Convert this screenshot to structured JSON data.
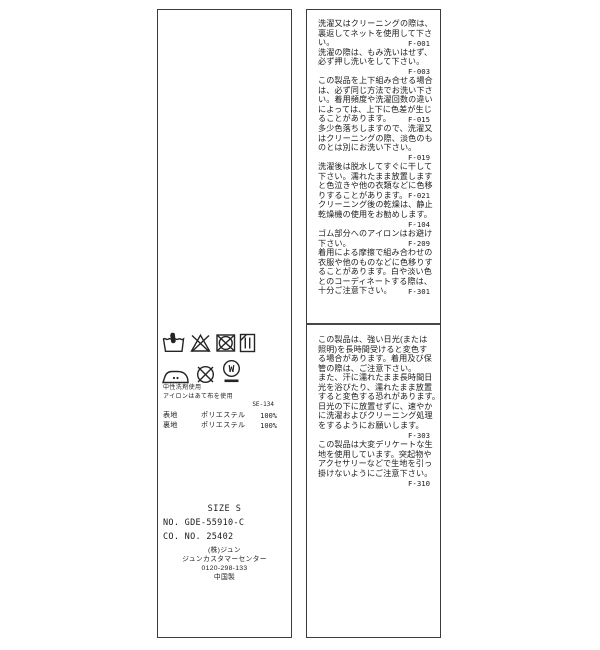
{
  "colors": {
    "background": "#ffffff",
    "label_background": "#ffffff",
    "border": "#3c3c3c",
    "text": "#1c1c1c",
    "divider": "#474747"
  },
  "left_label": {
    "care_symbols_row1": [
      "hand-wash",
      "do-not-bleach",
      "do-not-tumble-dry",
      "drip-dry-in-shade"
    ],
    "care_symbols_row2": [
      "iron-low-heat",
      "do-not-dryclean",
      "wet-clean-professional"
    ],
    "notes": [
      "中性洗剤使用",
      "アイロンはあて布を使用"
    ],
    "care_code": "SE-134",
    "composition": [
      {
        "part": "表地",
        "material": "ポリエステル",
        "pct": "100%"
      },
      {
        "part": "裏地",
        "material": "ポリエステル",
        "pct": "100%"
      }
    ],
    "size": "SIZE S",
    "item_no": "NO. GDE-55910-C",
    "co_no": "CO. NO. 25402",
    "company": [
      "(株)ジュン",
      "ジュンカスタマーセンター",
      "0120-298-133",
      "中国製"
    ]
  },
  "right_label": {
    "upper_lines": [
      {
        "text": "洗濯又はクリーニングの際は、"
      },
      {
        "text": "裏返してネットを使用して下さ"
      },
      {
        "text": "い。",
        "code": "F-001"
      },
      {
        "text": "洗濯の際は、もみ洗いはせず、"
      },
      {
        "text": "必ず押し洗いをして下さい。"
      },
      {
        "code": "F-003"
      },
      {
        "text": "この製品を上下組み合せる場合"
      },
      {
        "text": "は、必ず同じ方法でお洗い下さ"
      },
      {
        "text": "い。着用頻度や洗濯回数の違い"
      },
      {
        "text": "によっては、上下に色差が生じ"
      },
      {
        "text": "ることがあります。",
        "code": "F-015"
      },
      {
        "text": "多少色落ちしますので、洗濯又"
      },
      {
        "text": "はクリーニングの際、淡色のも"
      },
      {
        "text": "のとは別にお洗い下さい。"
      },
      {
        "code": "F-019"
      },
      {
        "text": "洗濯後は脱水してすぐに干して"
      },
      {
        "text": "下さい。濡れたまま放置します"
      },
      {
        "text": "と色泣きや他の衣類などに色移"
      },
      {
        "text": "りすることがあります。",
        "code": "F-021"
      },
      {
        "text": "クリーニング後の乾燥は、静止"
      },
      {
        "text": "乾燥機の使用をお勧めします。"
      },
      {
        "code": "F-104"
      },
      {
        "text": "ゴム部分へのアイロンはお避け"
      },
      {
        "text": "下さい。",
        "code": "F-209"
      },
      {
        "text": "着用による摩擦で組み合わせの"
      },
      {
        "text": "衣服や他のものなどに色移りす"
      },
      {
        "text": "ることがあります。白や淡い色"
      },
      {
        "text": "とのコーディネートする際は、"
      },
      {
        "text": "十分ご注意下さい。",
        "code": "F-301"
      }
    ],
    "lower_lines": [
      {
        "text": "この製品は、強い日光(または"
      },
      {
        "text": "照明)を長時間受けると変色す"
      },
      {
        "text": "る場合があります。着用及び保"
      },
      {
        "text": "管の際は、ご注意下さい。"
      },
      {
        "text": "また、汗に濡れたまま長時間日"
      },
      {
        "text": "光を浴びたり、濡れたまま放置"
      },
      {
        "text": "すると変色する恐れがあります。"
      },
      {
        "text": "日光の下に放置せずに、速やか"
      },
      {
        "text": "に洗濯およびクリーニング処理"
      },
      {
        "text": "をするようにお願いします。"
      },
      {
        "code": "F-303"
      },
      {
        "text": "この製品は大変デリケートな生"
      },
      {
        "text": "地を使用しています。突起物や"
      },
      {
        "text": "アクセサリーなどで生地を引っ"
      },
      {
        "text": "掛けないようにご注意下さい。"
      },
      {
        "code": "F-310"
      }
    ]
  }
}
